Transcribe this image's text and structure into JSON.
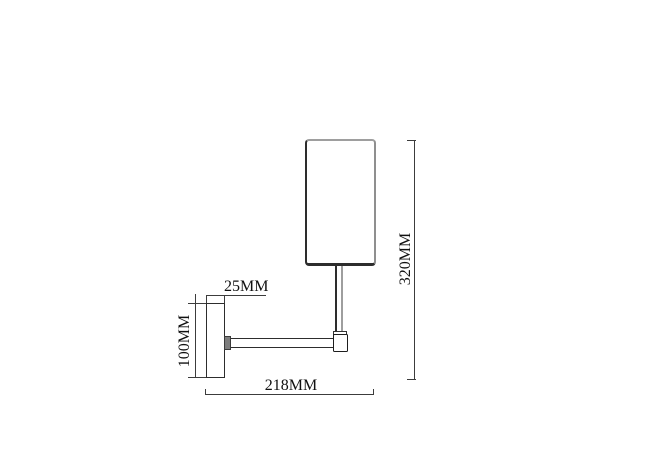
{
  "drawing": {
    "subject": "wall-lamp-technical-drawing",
    "line_color": "#3c3c3c",
    "outline_color": "#2d2d2d",
    "background_color": "#ffffff",
    "dimensions": {
      "plate_width_label": "25MM",
      "plate_height_label": "100MM",
      "overall_projection_label": "218MM",
      "overall_height_label": "320MM"
    }
  }
}
